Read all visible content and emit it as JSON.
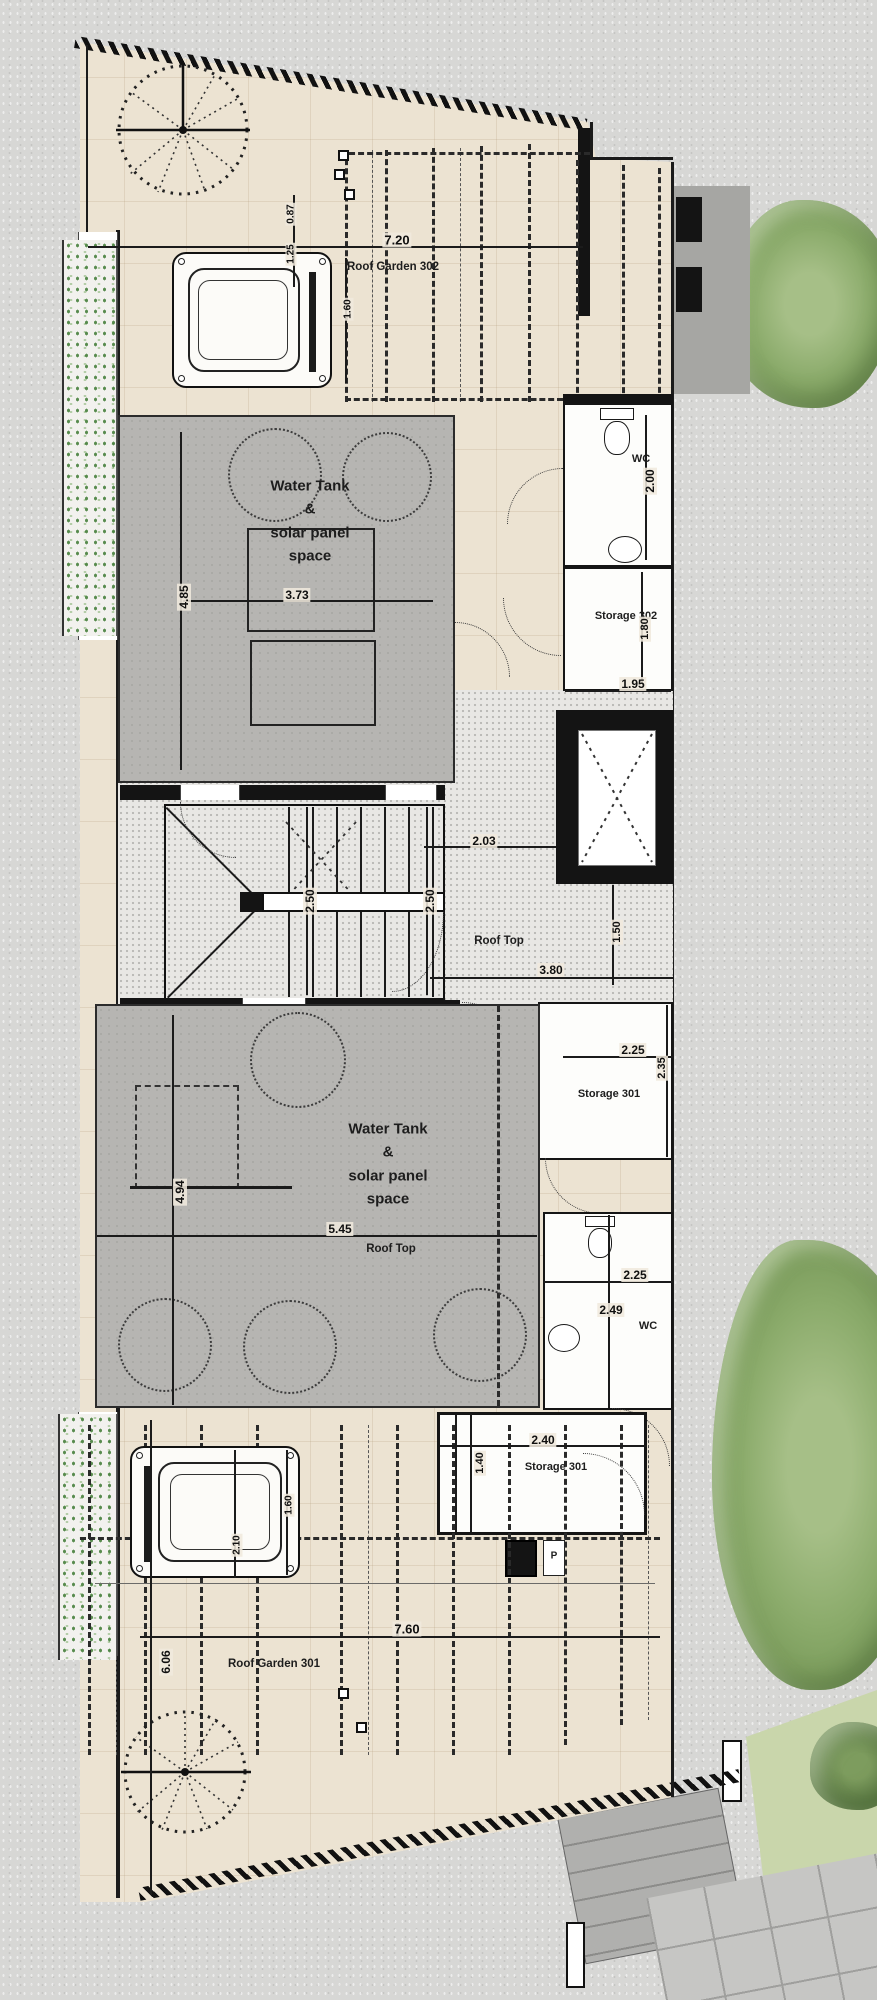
{
  "drawing": {
    "type": "roof floor plan",
    "units": [
      "301",
      "302"
    ]
  },
  "colors": {
    "paper_gray": "#d7d7d5",
    "plan_tile_beige": "#ece3d2",
    "gray_platform": "#b6b5b2",
    "granite_floor": "#e8e7e4",
    "wall_black": "#141414",
    "tree_green": "#8bab6b",
    "lawn_green": "#c9d6ab",
    "dim_text": "#101010"
  },
  "rooms": [
    {
      "name": "roof-garden-302",
      "label": "Roof Garden 302"
    },
    {
      "name": "water-tank-302",
      "label": "Water Tank\n&\nsolar panel\nspace"
    },
    {
      "name": "wc-302",
      "label": "WC"
    },
    {
      "name": "storage-302",
      "label": "Storage 302"
    },
    {
      "name": "roof-top-upper",
      "label": "Roof Top"
    },
    {
      "name": "storage-301-upper",
      "label": "Storage 301"
    },
    {
      "name": "water-tank-301",
      "label": "Water Tank\n&\nsolar panel\nspace"
    },
    {
      "name": "roof-top-lower",
      "label": "Roof Top"
    },
    {
      "name": "wc-301",
      "label": "WC"
    },
    {
      "name": "storage-301-lower",
      "label": "Storage 301"
    },
    {
      "name": "roof-garden-301",
      "label": "Roof Garden 301"
    },
    {
      "name": "electrical-panel",
      "label": "P"
    }
  ],
  "dimensions": [
    {
      "value": "7.20"
    },
    {
      "value": "0.87"
    },
    {
      "value": "1.25"
    },
    {
      "value": "1.60"
    },
    {
      "value": "4.85"
    },
    {
      "value": "3.73"
    },
    {
      "value": "2.00"
    },
    {
      "value": "1.80"
    },
    {
      "value": "1.95"
    },
    {
      "value": "2.03"
    },
    {
      "value": "2.50"
    },
    {
      "value": "2.50"
    },
    {
      "value": "1.50"
    },
    {
      "value": "3.80"
    },
    {
      "value": "2.25"
    },
    {
      "value": "2.35"
    },
    {
      "value": "5.45"
    },
    {
      "value": "4.94"
    },
    {
      "value": "2.25"
    },
    {
      "value": "2.49"
    },
    {
      "value": "2.40"
    },
    {
      "value": "1.40"
    },
    {
      "value": "1.60"
    },
    {
      "value": "2.10"
    },
    {
      "value": "7.60"
    },
    {
      "value": "6.06"
    }
  ]
}
